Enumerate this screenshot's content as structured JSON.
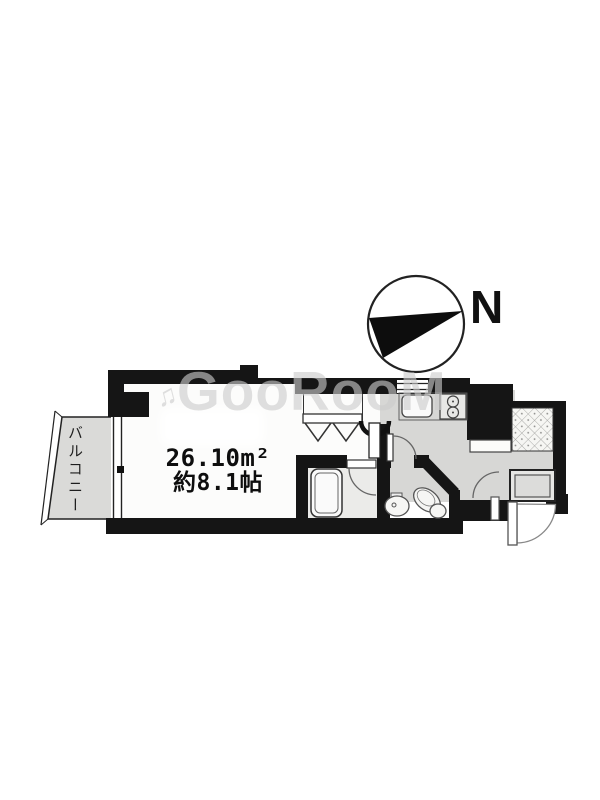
{
  "page": {
    "background": "#ffffff"
  },
  "compass": {
    "label": "N",
    "icon": "compass-needle"
  },
  "watermark": {
    "icon": "♫",
    "text": "GooRooM"
  },
  "floor_plan": {
    "balcony_label": "バルコニー",
    "room": {
      "area_m2": "26.10m²",
      "area_tatami": "約8.1帖"
    },
    "fixtures": [
      "closet-folding-doors",
      "bathtub",
      "toilet",
      "washbasin",
      "kitchen-sink",
      "two-burner-stove",
      "washing-machine-area",
      "entrance-tile",
      "entrance-door",
      "balcony-window"
    ],
    "colors": {
      "wall": "#151515",
      "floor_gray": "#d7d7d5",
      "room_white": "#fcfcfb",
      "balcony_gray": "#dadad8",
      "watermark_gray": "#cbcbcb"
    }
  }
}
